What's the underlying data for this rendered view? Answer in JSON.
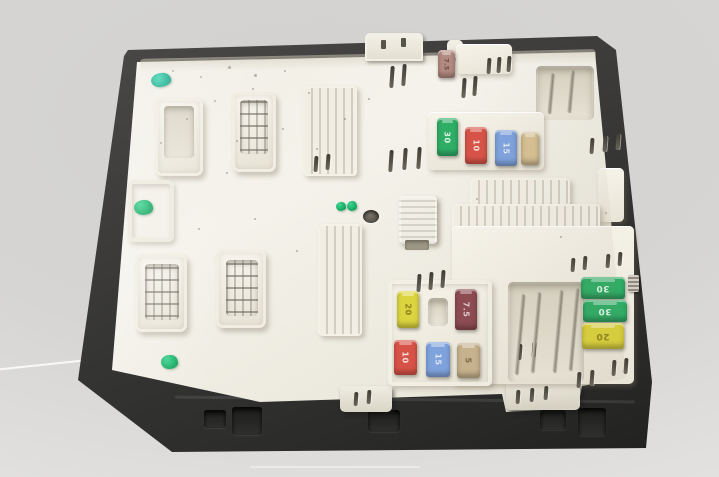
{
  "photo": {
    "subject": "Used automotive fuse box / body control module photographed on a plain light-gray background",
    "background_color": "#d6d5d3",
    "case_color": "#343433",
    "tray_color": "#efece3",
    "paint_mark_color": "#15aa62"
  },
  "fuses": [
    {
      "amps": "7.5",
      "color": "#b48b80",
      "label_color": "#6f4a42",
      "location": "top-center"
    },
    {
      "amps": "30",
      "color": "#2fae66",
      "label_color": "#eafff2",
      "location": "middle-row"
    },
    {
      "amps": "10",
      "color": "#d85347",
      "label_color": "#ffe9e6",
      "location": "middle-row"
    },
    {
      "amps": "15",
      "color": "#7fa3de",
      "label_color": "#eef3ff",
      "location": "middle-row"
    },
    {
      "amps": "",
      "color": "#d6c093",
      "label_color": "#8a7450",
      "location": "middle-row"
    },
    {
      "amps": "20",
      "color": "#ddd53f",
      "label_color": "#8d831c",
      "location": "lower-cluster"
    },
    {
      "amps": "7.5",
      "color": "#8d4b52",
      "label_color": "#f2dce0",
      "location": "lower-cluster"
    },
    {
      "amps": "10",
      "color": "#d85347",
      "label_color": "#ffe9e6",
      "location": "lower-cluster"
    },
    {
      "amps": "15",
      "color": "#7fa3de",
      "label_color": "#eef3ff",
      "location": "lower-cluster"
    },
    {
      "amps": "5",
      "color": "#c8b38e",
      "label_color": "#7c6845",
      "location": "lower-cluster"
    },
    {
      "amps": "30",
      "color": "#2fae66",
      "label_color": "#eafff2",
      "location": "right-stack"
    },
    {
      "amps": "30",
      "color": "#2fae66",
      "label_color": "#eafff2",
      "location": "right-stack"
    },
    {
      "amps": "20",
      "color": "#dcd33c",
      "label_color": "#8d831c",
      "location": "right-stack"
    }
  ],
  "decor": [
    {
      "layer": "slots-layer",
      "cls": "slot",
      "item_name": "vent-slot",
      "items": [
        {
          "x": 390,
          "y": 66,
          "h": 22
        },
        {
          "x": 402,
          "y": 64,
          "h": 22
        },
        {
          "x": 462,
          "y": 78,
          "h": 20
        },
        {
          "x": 473,
          "y": 76,
          "h": 20
        },
        {
          "x": 487,
          "y": 58,
          "h": 16
        },
        {
          "x": 497,
          "y": 57,
          "h": 16
        },
        {
          "x": 507,
          "y": 56,
          "h": 16
        },
        {
          "x": 314,
          "y": 156,
          "h": 16
        },
        {
          "x": 326,
          "y": 154,
          "h": 16
        },
        {
          "x": 389,
          "y": 150,
          "h": 22
        },
        {
          "x": 403,
          "y": 148,
          "h": 22
        },
        {
          "x": 417,
          "y": 147,
          "h": 22
        },
        {
          "x": 590,
          "y": 138,
          "h": 16
        },
        {
          "x": 603,
          "y": 136,
          "h": 16
        },
        {
          "x": 616,
          "y": 134,
          "h": 16
        },
        {
          "x": 417,
          "y": 274,
          "h": 18
        },
        {
          "x": 429,
          "y": 272,
          "h": 18
        },
        {
          "x": 441,
          "y": 270,
          "h": 18
        },
        {
          "x": 518,
          "y": 344,
          "h": 16
        },
        {
          "x": 532,
          "y": 342,
          "h": 16
        },
        {
          "x": 571,
          "y": 258,
          "h": 14
        },
        {
          "x": 583,
          "y": 256,
          "h": 14
        },
        {
          "x": 606,
          "y": 254,
          "h": 14
        },
        {
          "x": 618,
          "y": 252,
          "h": 14
        },
        {
          "x": 577,
          "y": 372,
          "h": 16
        },
        {
          "x": 590,
          "y": 370,
          "h": 16
        },
        {
          "x": 612,
          "y": 360,
          "h": 16
        },
        {
          "x": 624,
          "y": 358,
          "h": 16
        },
        {
          "x": 354,
          "y": 392,
          "h": 14
        },
        {
          "x": 367,
          "y": 390,
          "h": 14
        },
        {
          "x": 516,
          "y": 390,
          "h": 14
        },
        {
          "x": 530,
          "y": 388,
          "h": 14
        },
        {
          "x": 544,
          "y": 386,
          "h": 14
        }
      ]
    },
    {
      "layer": "pins-layer",
      "cls": "pin",
      "item_name": "terminal-pin",
      "items": [
        {
          "x": 549,
          "y": 73,
          "h": 40
        },
        {
          "x": 569,
          "y": 70,
          "h": 42
        },
        {
          "x": 518,
          "y": 294,
          "h": 80
        },
        {
          "x": 534,
          "y": 292,
          "h": 80
        },
        {
          "x": 556,
          "y": 290,
          "h": 82
        },
        {
          "x": 572,
          "y": 288,
          "h": 82
        }
      ]
    },
    {
      "layer": "speckles-layer",
      "cls": "speck",
      "item_name": "dust-speck",
      "items": [
        {
          "x": 172,
          "y": 70
        },
        {
          "x": 200,
          "y": 76
        },
        {
          "x": 228,
          "y": 66,
          "w": 3,
          "h": 3
        },
        {
          "x": 252,
          "y": 88
        },
        {
          "x": 284,
          "y": 70
        },
        {
          "x": 308,
          "y": 92
        },
        {
          "x": 186,
          "y": 118
        },
        {
          "x": 160,
          "y": 142
        },
        {
          "x": 282,
          "y": 128
        },
        {
          "x": 316,
          "y": 148
        },
        {
          "x": 226,
          "y": 172
        },
        {
          "x": 344,
          "y": 118
        },
        {
          "x": 368,
          "y": 98
        },
        {
          "x": 254,
          "y": 218
        },
        {
          "x": 296,
          "y": 250
        },
        {
          "x": 198,
          "y": 228
        },
        {
          "x": 476,
          "y": 198
        },
        {
          "x": 254,
          "y": 74,
          "w": 3,
          "h": 3
        },
        {
          "x": 214,
          "y": 100
        },
        {
          "x": 236,
          "y": 140
        },
        {
          "x": 560,
          "y": 236
        },
        {
          "x": 605,
          "y": 212
        }
      ]
    }
  ]
}
